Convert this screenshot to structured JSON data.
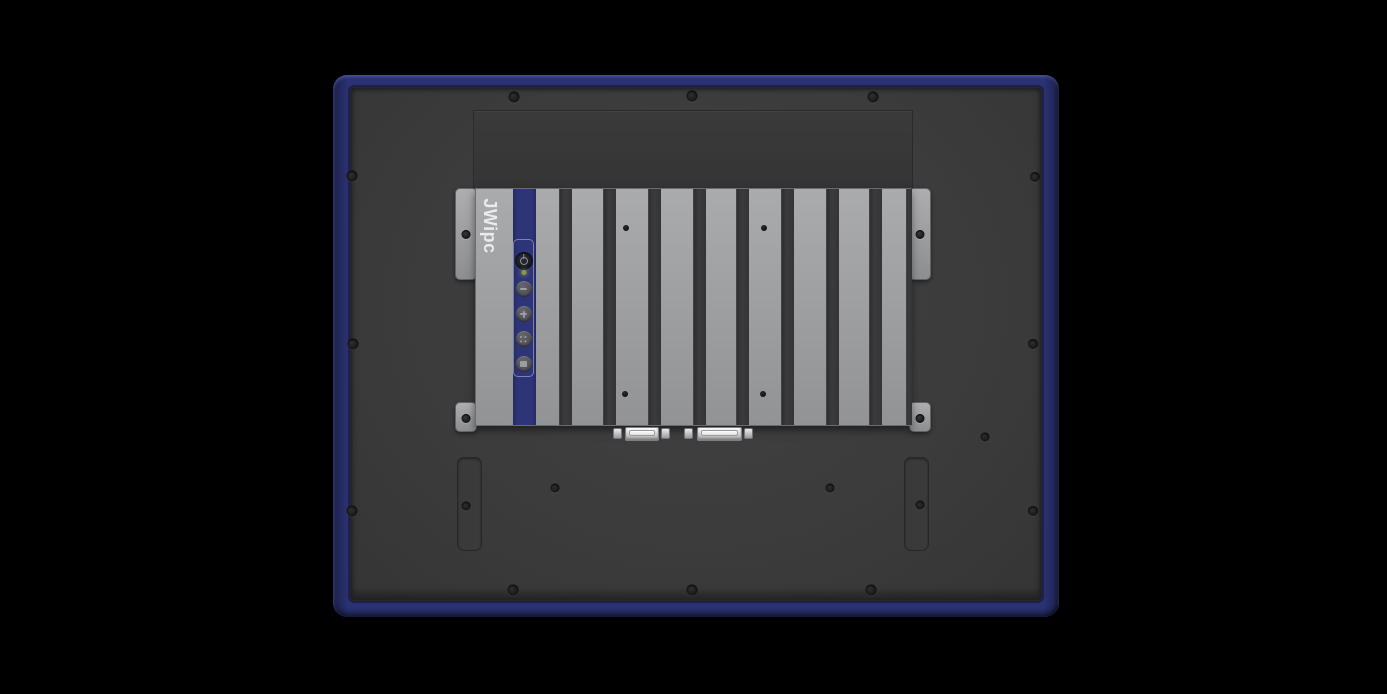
{
  "scene": {
    "subject": "industrial-panel-pc-rear-view",
    "background_color": "#000000"
  },
  "device": {
    "bezel_color": "#2b3273",
    "panel_color": "#3c3c3c",
    "plate_color": "#373737"
  },
  "module": {
    "brand": "JWipc",
    "stripe_color": "#2d3478",
    "body_color": "#a0a1a3",
    "fin_gap_color": "#333335",
    "fin_gaps": [
      {
        "x": 83,
        "w": 13
      },
      {
        "x": 127,
        "w": 13
      },
      {
        "x": 172,
        "w": 13
      },
      {
        "x": 217,
        "w": 13
      },
      {
        "x": 260,
        "w": 13
      },
      {
        "x": 305,
        "w": 13
      },
      {
        "x": 350,
        "w": 13
      },
      {
        "x": 393,
        "w": 13
      },
      {
        "x": 430,
        "w": 6
      }
    ],
    "fin_screws": [
      {
        "x": 150,
        "y": 39
      },
      {
        "x": 288,
        "y": 39
      },
      {
        "x": 149,
        "y": 205
      },
      {
        "x": 287,
        "y": 205
      }
    ],
    "ears": [
      {
        "name": "mounting-ear-top-left",
        "x": 455,
        "y": 188,
        "h": 92,
        "hole_y": 45
      },
      {
        "name": "mounting-ear-top-right",
        "x": 909,
        "y": 188,
        "h": 92,
        "hole_y": 45
      },
      {
        "name": "mounting-ear-bottom-left",
        "x": 455,
        "y": 402,
        "h": 30,
        "hole_y": 15
      },
      {
        "name": "mounting-ear-bottom-right",
        "x": 909,
        "y": 402,
        "h": 30,
        "hole_y": 15
      }
    ],
    "controls": {
      "power_button": {
        "name": "power-button",
        "icon": "power-icon"
      },
      "power_led": {
        "name": "power-led",
        "color": "#8a9a4b"
      },
      "osd_buttons": [
        {
          "name": "brightness-down-button",
          "icon": "minus-icon",
          "cls": "icon-minus",
          "y": 49
        },
        {
          "name": "brightness-up-button",
          "icon": "plus-icon",
          "cls": "icon-plus",
          "y": 74
        },
        {
          "name": "menu-button",
          "icon": "grid-icon",
          "cls": "icon-grid",
          "y": 99
        },
        {
          "name": "auto-button",
          "icon": "square-icon",
          "cls": "icon-square",
          "y": 124
        }
      ]
    },
    "ports": [
      {
        "name": "serial-connector",
        "body_x": 625,
        "body_w": 34,
        "posts": [
          613,
          661
        ]
      },
      {
        "name": "vga-connector",
        "body_x": 697,
        "body_w": 45,
        "posts": [
          684,
          744
        ]
      }
    ]
  },
  "panel_hardware": {
    "screws": [
      {
        "x": 514,
        "y": 97,
        "d": 11
      },
      {
        "x": 692,
        "y": 96,
        "d": 11
      },
      {
        "x": 873,
        "y": 97,
        "d": 11
      },
      {
        "x": 352,
        "y": 176,
        "d": 11
      },
      {
        "x": 1035,
        "y": 177,
        "d": 10
      },
      {
        "x": 353,
        "y": 344,
        "d": 11
      },
      {
        "x": 1033,
        "y": 344,
        "d": 10
      },
      {
        "x": 352,
        "y": 511,
        "d": 11
      },
      {
        "x": 1033,
        "y": 511,
        "d": 10
      },
      {
        "x": 513,
        "y": 590,
        "d": 11
      },
      {
        "x": 692,
        "y": 590,
        "d": 11
      },
      {
        "x": 871,
        "y": 590,
        "d": 11
      },
      {
        "x": 555,
        "y": 488,
        "d": 9
      },
      {
        "x": 830,
        "y": 488,
        "d": 9
      },
      {
        "x": 985,
        "y": 437,
        "d": 9
      }
    ],
    "slots": [
      {
        "name": "mounting-slot-left",
        "x": 457,
        "y": 457,
        "hole": {
          "x": 466,
          "y": 506
        }
      },
      {
        "name": "mounting-slot-right",
        "x": 904,
        "y": 457,
        "hole": {
          "x": 920,
          "y": 505
        }
      }
    ]
  }
}
